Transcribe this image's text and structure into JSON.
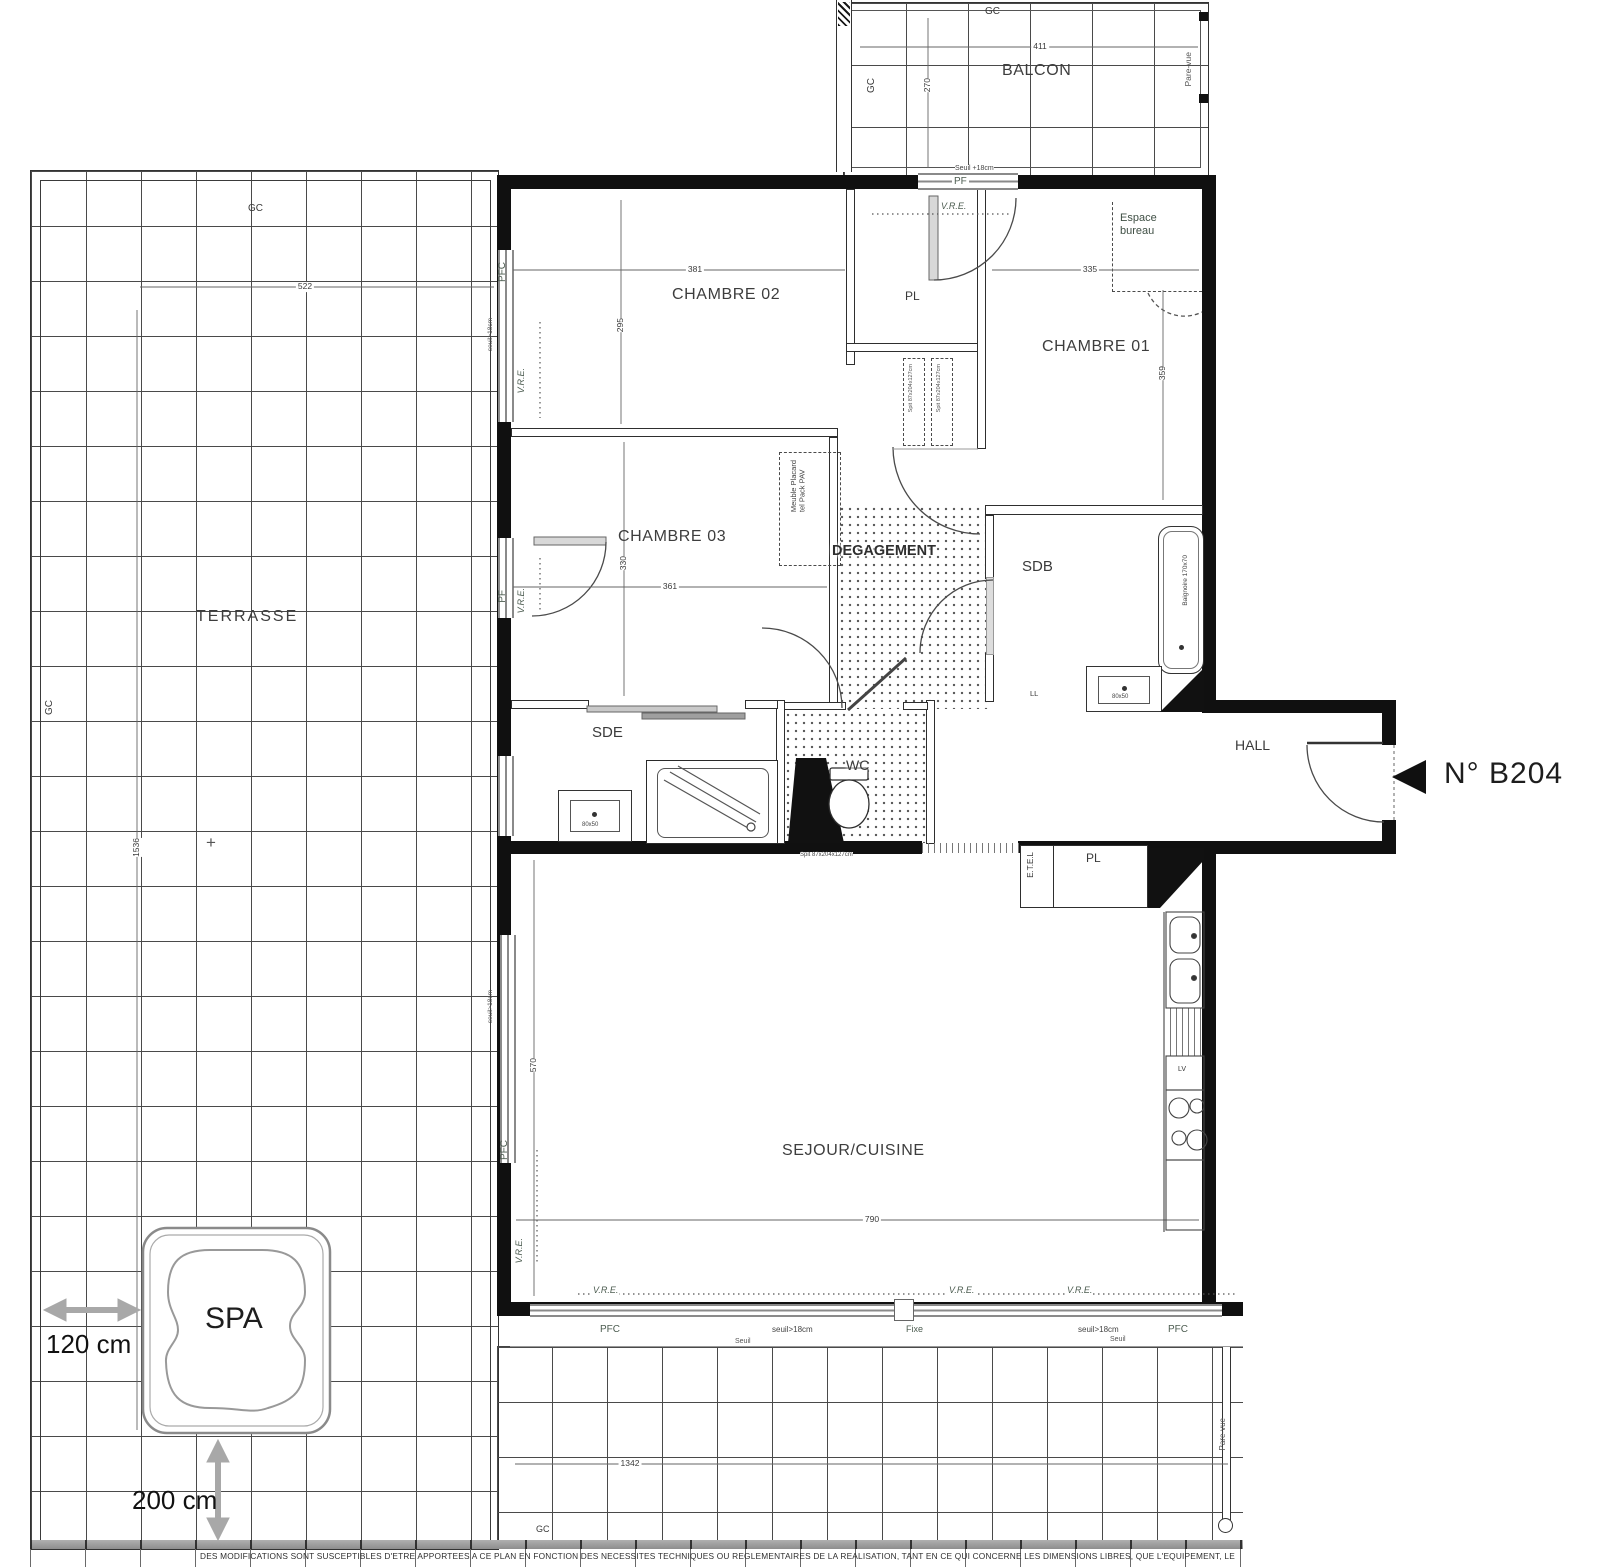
{
  "labels": {
    "balcon": "BALCON",
    "terrasse": "TERRASSE",
    "chambre01": "CHAMBRE 01",
    "chambre02": "CHAMBRE 02",
    "chambre03": "CHAMBRE 03",
    "degagement": "DEGAGEMENT",
    "sdb": "SDB",
    "sde": "SDE",
    "wc": "WC",
    "hall": "HALL",
    "sejour_cuisine": "SEJOUR/CUISINE",
    "pl": "PL",
    "spa": "SPA",
    "espace_bureau_1": "Espace",
    "espace_bureau_2": "bureau",
    "unit": "N° B204",
    "gc": "GC",
    "pf": "PF",
    "pfc": "PFC",
    "vre": "V.R.E.",
    "fixe": "Fixe",
    "seuil": "Seuil",
    "seuil18": "seuil>18cm",
    "seuil_plus18": "Seuil +18cm",
    "etel": "E.T.E.L",
    "parevue": "Pare-vue",
    "ll": "LL",
    "lv": "LV",
    "meuble_1": "Meuble Placard",
    "meuble_2": "tel Pack PAV",
    "baignoire": "Baignoire 170x70",
    "vasque_dim": "80x50",
    "spit": "Spit 87x204x127cm",
    "plus_mark": "+",
    "spa_w": "120 cm",
    "spa_h": "200 cm",
    "disclaimer": "DES MODIFICATIONS SONT SUSCEPTIBLES D'ETRE APPORTEES A CE PLAN EN FONCTION DES NECESSITES TECHNIQUES OU REGLEMENTAIRES DE LA REALISATION, TANT EN CE QUI CONCERNE LES DIMENSIONS LIBRES, QUE L'EQUIPEMENT, LE"
  },
  "dims": {
    "balcon_w": "411",
    "balcon_h": "270",
    "terrasse_w": "522",
    "terrasse_h": "1536",
    "terrasse_bottom": "1342",
    "ch2_w": "381",
    "ch2_h": "295",
    "ch1_w": "335",
    "ch1_h": "359",
    "ch3_w": "361",
    "ch3_h": "330",
    "sejour_w": "790",
    "sejour_h": "570"
  }
}
